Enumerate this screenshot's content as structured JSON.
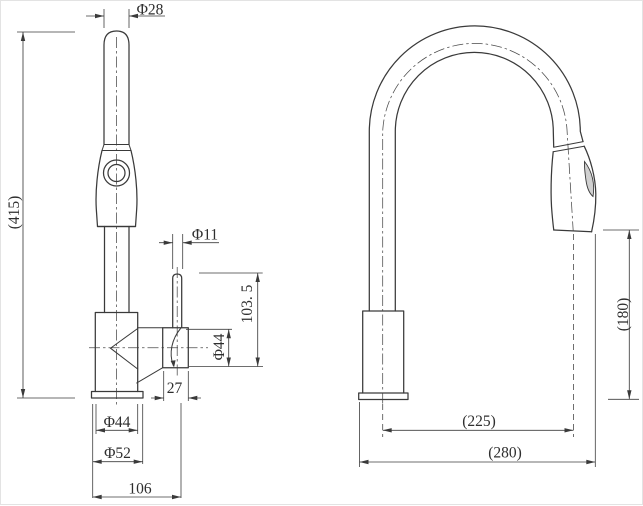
{
  "drawing": {
    "type": "faucet-technical-dimension-drawing",
    "background": "#ffffff",
    "line_color": "#3a3a3a",
    "text_color": "#2e2e2e"
  },
  "front_view": {
    "dim_spray_wand_diameter": "Φ28",
    "dim_total_height": "(415)",
    "dim_lever_diameter": "Φ11",
    "dim_lever_height": "103. 5",
    "dim_valve_body_diameter": "Φ44",
    "dim_valve_body_width": "27",
    "dim_base_body_diameter": "Φ44",
    "dim_base_flange_diameter": "Φ52",
    "dim_overall_width": "106"
  },
  "side_view": {
    "dim_spout_reach": "(225)",
    "dim_overall_depth": "(280)",
    "dim_spout_clearance": "(180)"
  }
}
